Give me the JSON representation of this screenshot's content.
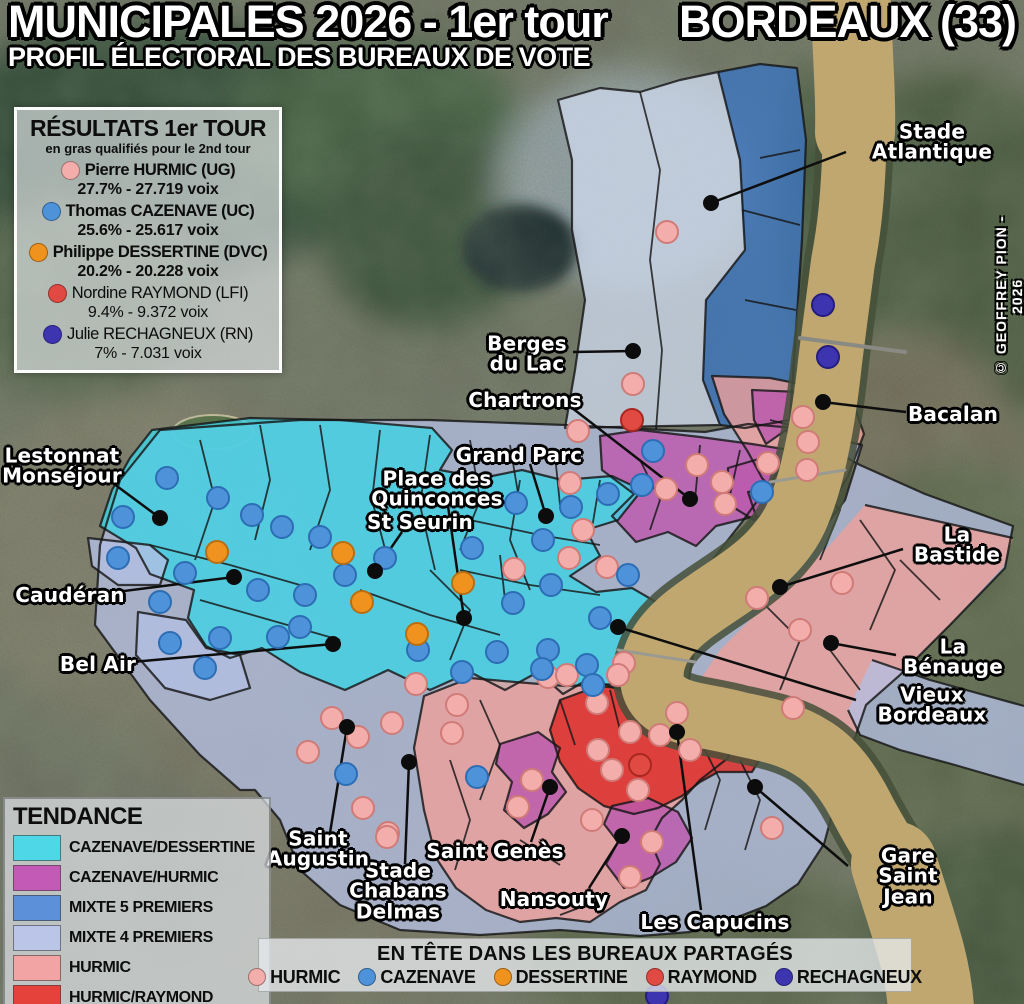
{
  "title": {
    "line1_left": "MUNICIPALES 2026 - 1er tour",
    "line1_right": "BORDEAUX (33)",
    "line2": "PROFIL ÉLECTORAL DES BUREAUX DE VOTE"
  },
  "credit": "© GEOFFREY PION - 2026",
  "results_legend": {
    "title": "RÉSULTATS 1er TOUR",
    "subtitle": "en gras qualifiés pour le 2nd tour",
    "candidates": [
      {
        "name": "Pierre HURMIC (UG)",
        "score": "27.7% - 27.719 voix",
        "color": "#f3adaa",
        "qualified": true
      },
      {
        "name": "Thomas CAZENAVE (UC)",
        "score": "25.6% - 25.617 voix",
        "color": "#4e92da",
        "qualified": true
      },
      {
        "name": "Philippe DESSERTINE (DVC)",
        "score": "20.2% - 20.228 voix",
        "color": "#f0921e",
        "qualified": true
      },
      {
        "name": "Nordine RAYMOND (LFI)",
        "score": "9.4% - 9.372 voix",
        "color": "#e14a43",
        "qualified": false
      },
      {
        "name": "Julie RECHAGNEUX (RN)",
        "score": "7% - 7.031 voix",
        "color": "#3d34b0",
        "qualified": false
      }
    ]
  },
  "tendance_legend": {
    "title": "TENDANCE",
    "items": [
      {
        "label": "CAZENAVE/DESSERTINE",
        "color": "#4ed7e6"
      },
      {
        "label": "CAZENAVE/HURMIC",
        "color": "#c35ab5"
      },
      {
        "label": "MIXTE 5 PREMIERS",
        "color": "#5c90d8"
      },
      {
        "label": "MIXTE 4 PREMIERS",
        "color": "#bac5e8"
      },
      {
        "label": "HURMIC",
        "color": "#f2a3a3"
      },
      {
        "label": "HURMIC/RAYMOND",
        "color": "#e6423c"
      }
    ]
  },
  "shared_legend": {
    "title": "EN TÊTE DANS LES BUREAUX PARTAGÉS",
    "items": [
      {
        "label": "HURMIC",
        "color": "#f3adaa"
      },
      {
        "label": "CAZENAVE",
        "color": "#4e92da"
      },
      {
        "label": "DESSERTINE",
        "color": "#f0921e"
      },
      {
        "label": "RAYMOND",
        "color": "#e14a43"
      },
      {
        "label": "RECHAGNEUX",
        "color": "#3d34b0"
      }
    ]
  },
  "palette": {
    "hurmic": {
      "fill": "#f3adaa",
      "stroke": "#cf7b78"
    },
    "cazenave": {
      "fill": "#4e92da",
      "stroke": "#2d6db4"
    },
    "dessertine": {
      "fill": "#f0921e",
      "stroke": "#b96e12"
    },
    "raymond": {
      "fill": "#e14a43",
      "stroke": "#a82721"
    },
    "rechagneux": {
      "fill": "#3d34b0",
      "stroke": "#241c7e"
    }
  },
  "map": {
    "labels": [
      {
        "text": "Stade Atlantique",
        "x": 932,
        "y": 142,
        "line": {
          "x1": 846,
          "y1": 152,
          "x2": 711,
          "y2": 203
        }
      },
      {
        "text": "Berges\ndu Lac",
        "x": 527,
        "y": 354,
        "line": {
          "x1": 573,
          "y1": 352,
          "x2": 633,
          "y2": 351
        }
      },
      {
        "text": "Chartrons",
        "x": 525,
        "y": 400,
        "line": {
          "x1": 567,
          "y1": 404,
          "x2": 690,
          "y2": 499
        }
      },
      {
        "text": "Grand Parc",
        "x": 519,
        "y": 455,
        "line": {
          "x1": 530,
          "y1": 464,
          "x2": 546,
          "y2": 516
        }
      },
      {
        "text": "Place des\nQuinconces",
        "x": 437,
        "y": 489,
        "line": {
          "x1": 448,
          "y1": 506,
          "x2": 464,
          "y2": 618
        }
      },
      {
        "text": "St Seurin",
        "x": 420,
        "y": 522,
        "line": {
          "x1": 402,
          "y1": 532,
          "x2": 375,
          "y2": 571
        }
      },
      {
        "text": "Lestonnat\nMonséjour",
        "x": 62,
        "y": 466,
        "line": {
          "x1": 106,
          "y1": 478,
          "x2": 160,
          "y2": 518
        }
      },
      {
        "text": "Caudéran",
        "x": 70,
        "y": 595,
        "line": {
          "x1": 116,
          "y1": 592,
          "x2": 234,
          "y2": 577
        }
      },
      {
        "text": "Bel Air",
        "x": 98,
        "y": 664,
        "line": {
          "x1": 132,
          "y1": 662,
          "x2": 333,
          "y2": 644
        }
      },
      {
        "text": "Bacalan",
        "x": 953,
        "y": 414,
        "line": {
          "x1": 906,
          "y1": 412,
          "x2": 823,
          "y2": 402
        }
      },
      {
        "text": "La Bastide",
        "x": 957,
        "y": 545,
        "line": {
          "x1": 903,
          "y1": 549,
          "x2": 780,
          "y2": 587
        }
      },
      {
        "text": "La Bénauge",
        "x": 953,
        "y": 657,
        "line": {
          "x1": 896,
          "y1": 655,
          "x2": 831,
          "y2": 643
        }
      },
      {
        "text": "Vieux Bordeaux",
        "x": 932,
        "y": 705,
        "line": {
          "x1": 856,
          "y1": 700,
          "x2": 618,
          "y2": 627
        }
      },
      {
        "text": "Gare Saint Jean",
        "x": 908,
        "y": 876,
        "line": {
          "x1": 848,
          "y1": 866,
          "x2": 755,
          "y2": 787
        }
      },
      {
        "text": "Les Capucins",
        "x": 715,
        "y": 922,
        "line": {
          "x1": 701,
          "y1": 910,
          "x2": 677,
          "y2": 732
        }
      },
      {
        "text": "Nansouty",
        "x": 554,
        "y": 899,
        "line": {
          "x1": 589,
          "y1": 888,
          "x2": 622,
          "y2": 836
        }
      },
      {
        "text": "Saint Genès",
        "x": 495,
        "y": 851,
        "line": {
          "x1": 531,
          "y1": 842,
          "x2": 550,
          "y2": 787
        }
      },
      {
        "text": "Stade\nChabans\nDelmas",
        "x": 398,
        "y": 891,
        "line": {
          "x1": 405,
          "y1": 864,
          "x2": 409,
          "y2": 762
        }
      },
      {
        "text": "Saint\nAugustin",
        "x": 318,
        "y": 849,
        "line": {
          "x1": 330,
          "y1": 833,
          "x2": 347,
          "y2": 727
        }
      }
    ],
    "bureau_dots": [
      {
        "x": 667,
        "y": 232,
        "c": "hurmic"
      },
      {
        "x": 633,
        "y": 384,
        "c": "hurmic"
      },
      {
        "x": 578,
        "y": 431,
        "c": "hurmic"
      },
      {
        "x": 803,
        "y": 417,
        "c": "hurmic"
      },
      {
        "x": 808,
        "y": 442,
        "c": "hurmic"
      },
      {
        "x": 807,
        "y": 470,
        "c": "hurmic"
      },
      {
        "x": 697,
        "y": 465,
        "c": "hurmic"
      },
      {
        "x": 722,
        "y": 482,
        "c": "hurmic"
      },
      {
        "x": 725,
        "y": 504,
        "c": "hurmic"
      },
      {
        "x": 768,
        "y": 463,
        "c": "hurmic"
      },
      {
        "x": 666,
        "y": 489,
        "c": "hurmic"
      },
      {
        "x": 757,
        "y": 598,
        "c": "hurmic"
      },
      {
        "x": 800,
        "y": 630,
        "c": "hurmic"
      },
      {
        "x": 842,
        "y": 583,
        "c": "hurmic"
      },
      {
        "x": 793,
        "y": 708,
        "c": "hurmic"
      },
      {
        "x": 772,
        "y": 828,
        "c": "hurmic"
      },
      {
        "x": 570,
        "y": 483,
        "c": "hurmic"
      },
      {
        "x": 583,
        "y": 530,
        "c": "hurmic"
      },
      {
        "x": 569,
        "y": 558,
        "c": "hurmic"
      },
      {
        "x": 514,
        "y": 569,
        "c": "hurmic"
      },
      {
        "x": 607,
        "y": 567,
        "c": "hurmic"
      },
      {
        "x": 624,
        "y": 663,
        "c": "hurmic"
      },
      {
        "x": 548,
        "y": 677,
        "c": "hurmic"
      },
      {
        "x": 567,
        "y": 675,
        "c": "hurmic"
      },
      {
        "x": 416,
        "y": 684,
        "c": "hurmic"
      },
      {
        "x": 598,
        "y": 750,
        "c": "hurmic"
      },
      {
        "x": 630,
        "y": 732,
        "c": "hurmic"
      },
      {
        "x": 677,
        "y": 713,
        "c": "hurmic"
      },
      {
        "x": 660,
        "y": 735,
        "c": "hurmic"
      },
      {
        "x": 690,
        "y": 750,
        "c": "hurmic"
      },
      {
        "x": 612,
        "y": 770,
        "c": "hurmic"
      },
      {
        "x": 638,
        "y": 790,
        "c": "hurmic"
      },
      {
        "x": 597,
        "y": 703,
        "c": "hurmic"
      },
      {
        "x": 618,
        "y": 675,
        "c": "hurmic"
      },
      {
        "x": 532,
        "y": 780,
        "c": "hurmic"
      },
      {
        "x": 518,
        "y": 807,
        "c": "hurmic"
      },
      {
        "x": 652,
        "y": 842,
        "c": "hurmic"
      },
      {
        "x": 630,
        "y": 877,
        "c": "hurmic"
      },
      {
        "x": 592,
        "y": 820,
        "c": "hurmic"
      },
      {
        "x": 388,
        "y": 833,
        "c": "hurmic"
      },
      {
        "x": 332,
        "y": 718,
        "c": "hurmic"
      },
      {
        "x": 358,
        "y": 737,
        "c": "hurmic"
      },
      {
        "x": 392,
        "y": 723,
        "c": "hurmic"
      },
      {
        "x": 308,
        "y": 752,
        "c": "hurmic"
      },
      {
        "x": 363,
        "y": 808,
        "c": "hurmic"
      },
      {
        "x": 387,
        "y": 837,
        "c": "hurmic"
      },
      {
        "x": 457,
        "y": 705,
        "c": "hurmic"
      },
      {
        "x": 452,
        "y": 733,
        "c": "hurmic"
      },
      {
        "x": 167,
        "y": 478,
        "c": "cazenave"
      },
      {
        "x": 218,
        "y": 498,
        "c": "cazenave"
      },
      {
        "x": 123,
        "y": 517,
        "c": "cazenave"
      },
      {
        "x": 252,
        "y": 515,
        "c": "cazenave"
      },
      {
        "x": 282,
        "y": 527,
        "c": "cazenave"
      },
      {
        "x": 320,
        "y": 537,
        "c": "cazenave"
      },
      {
        "x": 118,
        "y": 558,
        "c": "cazenave"
      },
      {
        "x": 185,
        "y": 573,
        "c": "cazenave"
      },
      {
        "x": 258,
        "y": 590,
        "c": "cazenave"
      },
      {
        "x": 160,
        "y": 602,
        "c": "cazenave"
      },
      {
        "x": 220,
        "y": 638,
        "c": "cazenave"
      },
      {
        "x": 170,
        "y": 643,
        "c": "cazenave"
      },
      {
        "x": 205,
        "y": 668,
        "c": "cazenave"
      },
      {
        "x": 278,
        "y": 637,
        "c": "cazenave"
      },
      {
        "x": 305,
        "y": 595,
        "c": "cazenave"
      },
      {
        "x": 345,
        "y": 575,
        "c": "cazenave"
      },
      {
        "x": 385,
        "y": 558,
        "c": "cazenave"
      },
      {
        "x": 300,
        "y": 627,
        "c": "cazenave"
      },
      {
        "x": 418,
        "y": 650,
        "c": "cazenave"
      },
      {
        "x": 462,
        "y": 672,
        "c": "cazenave"
      },
      {
        "x": 346,
        "y": 774,
        "c": "cazenave"
      },
      {
        "x": 477,
        "y": 777,
        "c": "cazenave"
      },
      {
        "x": 516,
        "y": 503,
        "c": "cazenave"
      },
      {
        "x": 571,
        "y": 507,
        "c": "cazenave"
      },
      {
        "x": 543,
        "y": 540,
        "c": "cazenave"
      },
      {
        "x": 472,
        "y": 548,
        "c": "cazenave"
      },
      {
        "x": 551,
        "y": 585,
        "c": "cazenave"
      },
      {
        "x": 513,
        "y": 603,
        "c": "cazenave"
      },
      {
        "x": 628,
        "y": 575,
        "c": "cazenave"
      },
      {
        "x": 548,
        "y": 650,
        "c": "cazenave"
      },
      {
        "x": 497,
        "y": 652,
        "c": "cazenave"
      },
      {
        "x": 542,
        "y": 669,
        "c": "cazenave"
      },
      {
        "x": 600,
        "y": 618,
        "c": "cazenave"
      },
      {
        "x": 587,
        "y": 665,
        "c": "cazenave"
      },
      {
        "x": 593,
        "y": 685,
        "c": "cazenave"
      },
      {
        "x": 653,
        "y": 451,
        "c": "cazenave"
      },
      {
        "x": 642,
        "y": 485,
        "c": "cazenave"
      },
      {
        "x": 608,
        "y": 494,
        "c": "cazenave"
      },
      {
        "x": 762,
        "y": 492,
        "c": "cazenave"
      },
      {
        "x": 217,
        "y": 552,
        "c": "dessertine"
      },
      {
        "x": 343,
        "y": 553,
        "c": "dessertine"
      },
      {
        "x": 362,
        "y": 602,
        "c": "dessertine"
      },
      {
        "x": 463,
        "y": 583,
        "c": "dessertine"
      },
      {
        "x": 417,
        "y": 634,
        "c": "dessertine"
      },
      {
        "x": 632,
        "y": 420,
        "c": "raymond"
      },
      {
        "x": 640,
        "y": 765,
        "c": "raymond"
      },
      {
        "x": 823,
        "y": 305,
        "c": "rechagneux"
      },
      {
        "x": 828,
        "y": 357,
        "c": "rechagneux"
      },
      {
        "x": 657,
        "y": 996,
        "c": "rechagneux"
      }
    ]
  }
}
